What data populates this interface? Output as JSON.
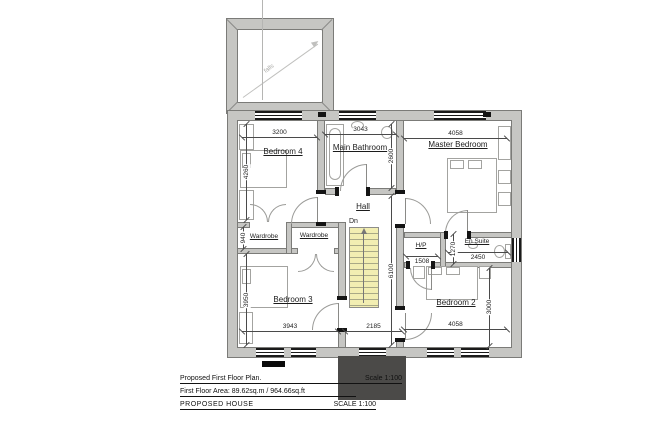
{
  "colors": {
    "wall_fill": "#c6c6c3",
    "wall_edge": "#7b7b78",
    "stairs_fill": "#f2eeb2",
    "dark_block": "#4b4a48",
    "window_frame": "#1a1a1a"
  },
  "roof": {
    "falls_label": "falls"
  },
  "rooms": {
    "bedroom4": "Bedroom 4",
    "main_bathroom": "Main Bathroom",
    "master_bedroom": "Master Bedroom",
    "hall": "Hall",
    "wardrobe_left": "Wardrobe",
    "wardrobe_right": "Wardrobe",
    "hp": "H/P",
    "en_suite": "En Suite",
    "bedroom3": "Bedroom 3",
    "bedroom2": "Bedroom 2"
  },
  "stairs": {
    "down_label": "Dn"
  },
  "dimensions": {
    "bedroom4_width": "3200",
    "bathroom_width": "3043",
    "master_width": "4058",
    "bathroom_depth": "2600",
    "bedroom4_depth": "4260",
    "wardrobe_depth": "940",
    "bedroom3_depth": "3950",
    "hall_depth": "6100",
    "hp_width": "1508",
    "hp_depth": "1270",
    "ensuite_width": "2450",
    "bedroom2_depth": "3000",
    "bedroom3_width": "3943",
    "landing_width": "2185",
    "bedroom2_width": "4058"
  },
  "title_block": {
    "line1_left": "Proposed First Floor Plan.",
    "line1_right": "Scale 1:100",
    "line2": "First Floor Area:  89.62sq.m / 964.66sq.ft",
    "line3_left": "PROPOSED  HOUSE",
    "line3_right": "SCALE 1:100"
  }
}
